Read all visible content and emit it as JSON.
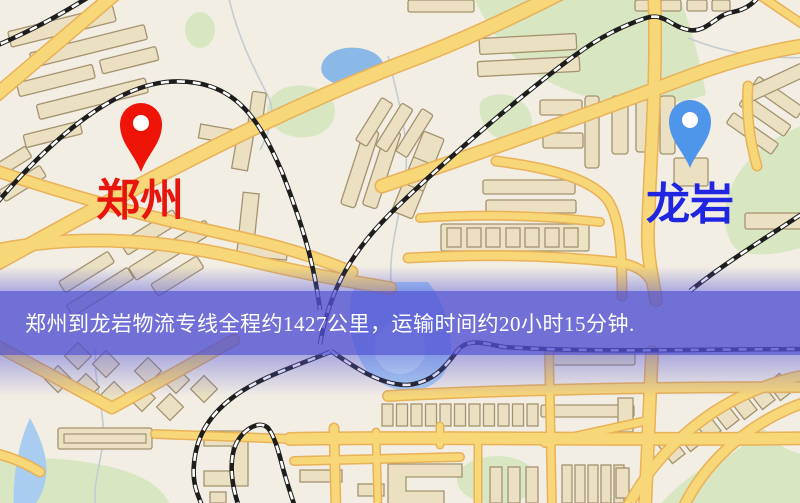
{
  "window": {
    "width": 800,
    "height": 503
  },
  "map": {
    "background": "#f3eee4",
    "road_color": "#f8d779",
    "road_casing_color": "#e9b158",
    "park_color": "#d8e7c2",
    "water_color": "#8ab9e8",
    "building_color": "#ebe1c2",
    "railway_color": "#1d1d1d"
  },
  "markers": {
    "origin": {
      "label": "郑州",
      "pin_color": "#ee1508",
      "label_color": "#e8150d"
    },
    "destination": {
      "label": "龙岩",
      "pin_color": "#4f96ea",
      "label_color": "#1f25e0"
    }
  },
  "banner": {
    "text": "郑州到龙岩物流专线全程约1427公里，运输时间约20小时15分钟.",
    "background_color": "#5050d2",
    "text_color": "#ffffff"
  },
  "route": {
    "origin": "郑州",
    "destination": "龙岩",
    "distance_text": "全程约1427公里",
    "duration_text": "运输时间约20小时15分钟"
  }
}
